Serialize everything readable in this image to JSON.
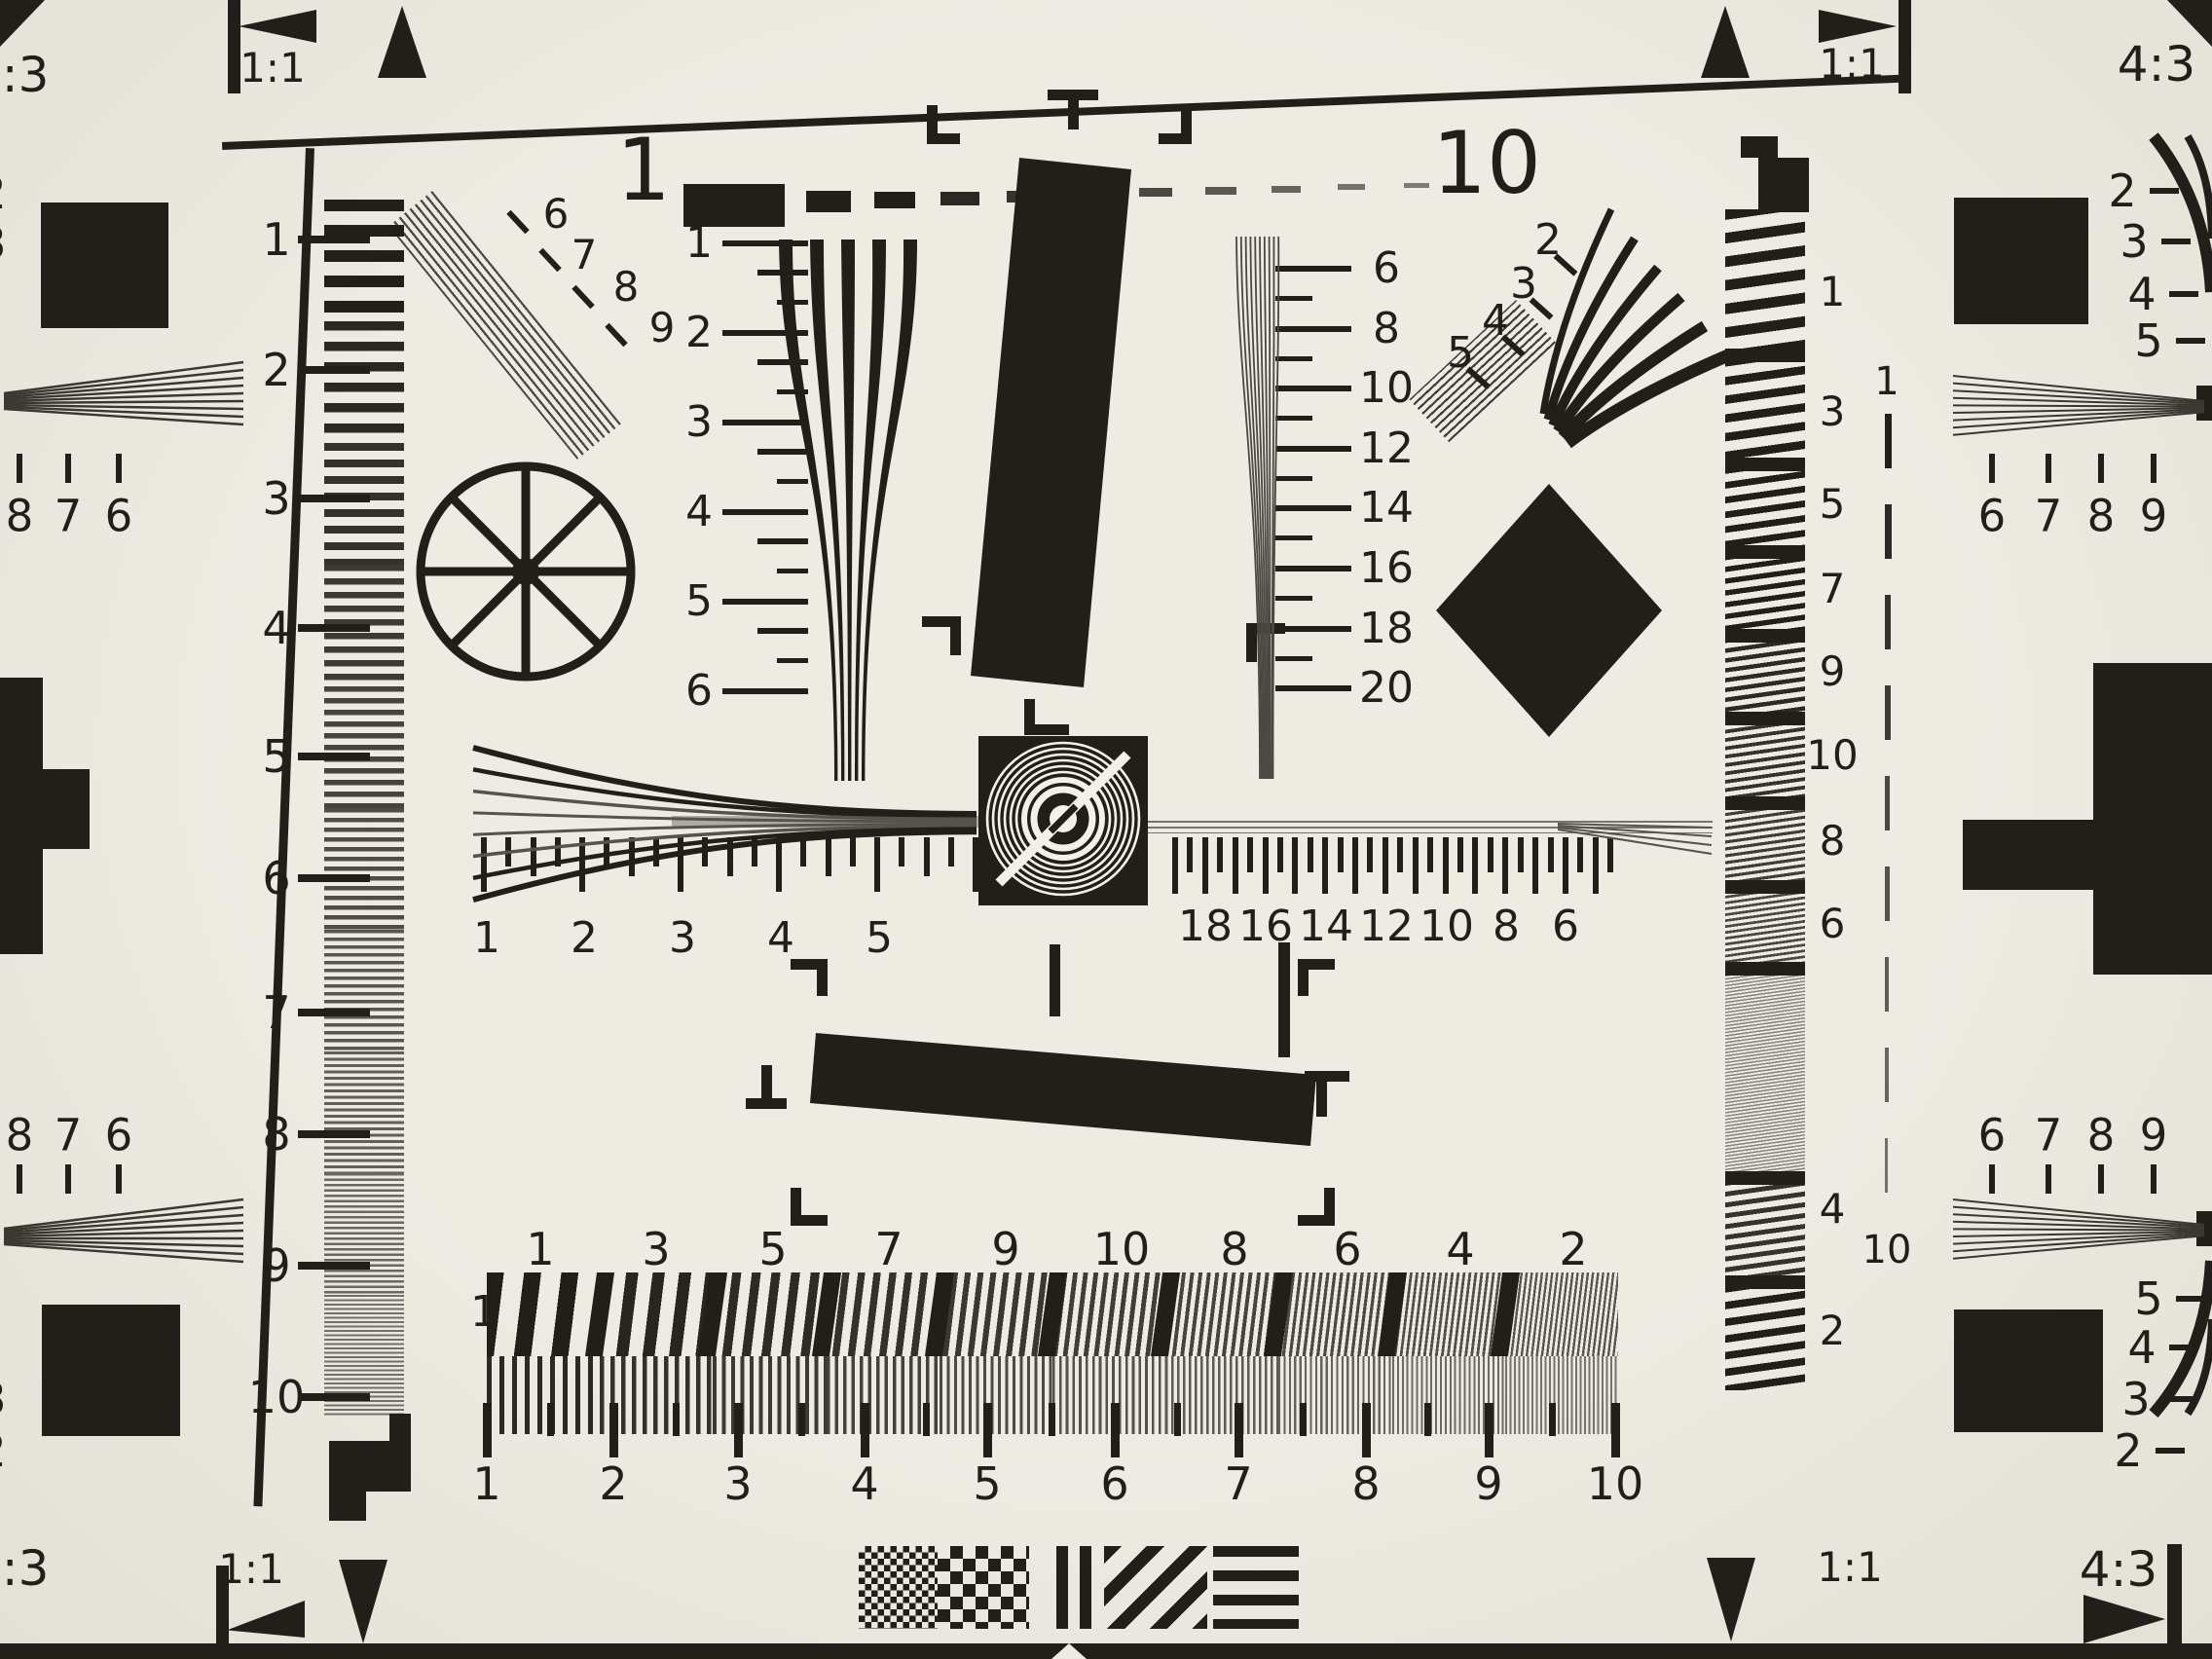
{
  "title": "resolution-test-chart-photo",
  "colors": {
    "background": "#ebe8df",
    "ink": "#211f1a",
    "gray": "#8b897f"
  },
  "corner_labels": {
    "aspect": "4:3",
    "square": "1:1"
  },
  "top_ruler": {
    "start": "1",
    "end": "10"
  },
  "left_ruler": [
    "1",
    "2",
    "3",
    "4",
    "5",
    "6",
    "7",
    "8",
    "9",
    "10"
  ],
  "left_wedge_scale": [
    "1",
    "2",
    "3",
    "4",
    "5",
    "6"
  ],
  "nw_fan_scale": [
    "6",
    "7",
    "8",
    "9"
  ],
  "right_wedge_scale": [
    "6",
    "8",
    "10",
    "12",
    "14",
    "16",
    "18",
    "20"
  ],
  "ne_fan_scale": [
    "2",
    "3",
    "4",
    "5"
  ],
  "center_ruler_left": [
    "1",
    "2",
    "3",
    "4",
    "5"
  ],
  "center_ruler_right": [
    "18",
    "16",
    "14",
    "12",
    "10",
    "8",
    "6"
  ],
  "bar_row_label": "1",
  "bar_numbers": [
    "1",
    "3",
    "5",
    "7",
    "9",
    "10",
    "8",
    "6",
    "4",
    "2"
  ],
  "bottom_ruler": [
    "1",
    "2",
    "3",
    "4",
    "5",
    "6",
    "7",
    "8",
    "9",
    "10"
  ],
  "right_column": [
    "1",
    "3",
    "5",
    "7",
    "9",
    "10",
    "8",
    "6",
    "4",
    "2"
  ],
  "right_dashed": {
    "top": "1",
    "bottom": "10"
  },
  "edge_right_top_scale": [
    "2",
    "3",
    "4",
    "5"
  ],
  "edge_right_bottom_scale": [
    "5",
    "4",
    "3",
    "2"
  ],
  "edge_left_top_cut": [
    "2",
    "3"
  ],
  "edge_left_bottom_cut": [
    "3",
    "2"
  ],
  "edge_fan_right_top": [
    "6",
    "7",
    "8",
    "9"
  ],
  "edge_fan_right_bottom": [
    "6",
    "7",
    "8",
    "9"
  ],
  "edge_fan_left_top": [
    "8",
    "7",
    "6"
  ],
  "edge_fan_left_bottom": [
    "8",
    "7",
    "6"
  ]
}
